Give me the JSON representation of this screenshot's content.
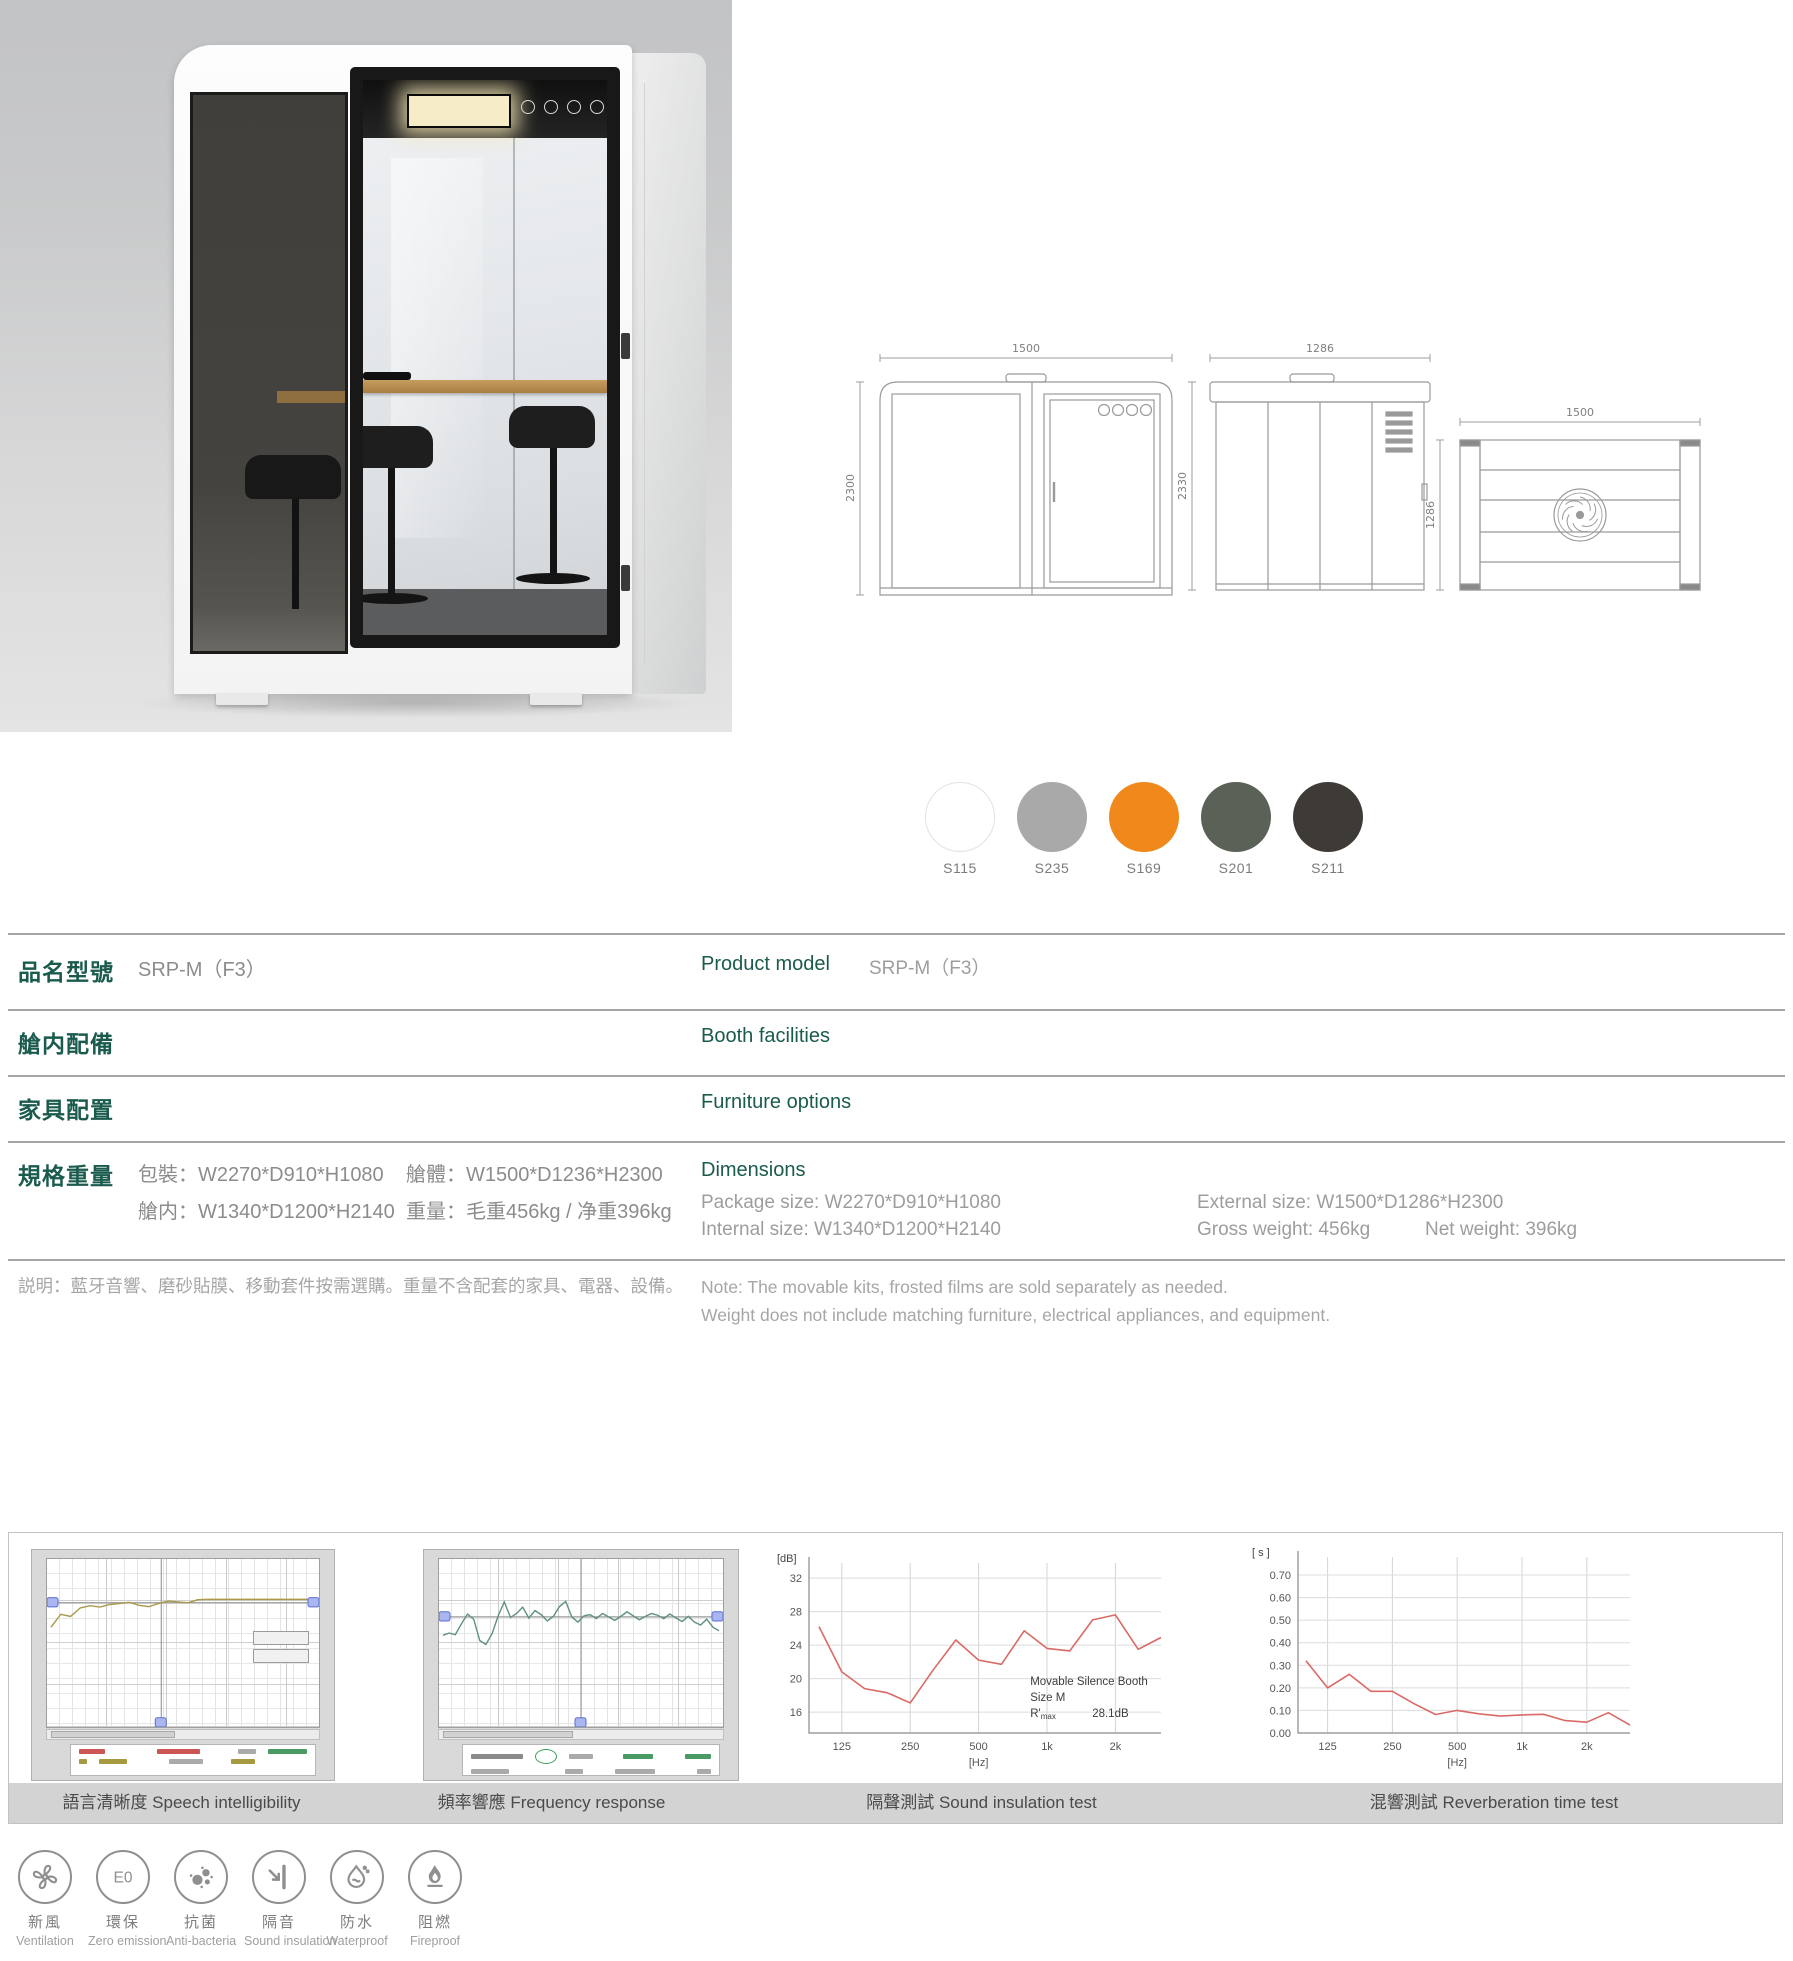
{
  "hero": {
    "drawings": {
      "front": {
        "width_mm": "1500",
        "height_mm": "2300"
      },
      "side": {
        "width_mm": "1286",
        "height_mm": "2330"
      },
      "top": {
        "width_mm": "1500",
        "depth_mm": "1286"
      }
    },
    "swatches": [
      {
        "code": "S115",
        "hex": "#ffffff"
      },
      {
        "code": "S235",
        "hex": "#a9a9a9"
      },
      {
        "code": "S169",
        "hex": "#f0881c"
      },
      {
        "code": "S201",
        "hex": "#5a6156"
      },
      {
        "code": "S211",
        "hex": "#3e3b37"
      }
    ]
  },
  "spec": {
    "accent_color": "#1a5b4d",
    "model": {
      "zh_label": "品名型號",
      "zh_value": "SRP-M（F3）",
      "en_label": "Product model",
      "en_value": "SRP-M（F3）"
    },
    "facilities": {
      "zh_label": "艙内配備",
      "zh_items": [
        "★適配100-240V/50-60Hz電源供應系統，符合不同電源使用需求",
        "★艙室4000K/750Lux自然光中央照明系統",
        "★渦輪正壓新風系統",
        "★紅外感應啓動裝置+手動開關",
        "★應急安全槌",
        "★雙層非等厚夾膠玻璃",
        "★加强框體液壓艙門"
      ],
      "en_label": "Booth facilities",
      "en_items": [
        "★ 100-240V/50-60Hz power supply.",
        "★ 4000K/750Lux natural lighting system.",
        "★ Turbo fresh air system.",
        "★ Motion sensor and switch control for light and fan.",
        "★ Emergency safety hammer.",
        "★ Double-layer non-equal thick laminated glass",
        "★ Advanced framed hydraulic door."
      ]
    },
    "furniture": {
      "zh_label": "家具配置",
      "zh_items": [
        "ST-03 吧臺桌 * 1",
        "SY-01 高脚椅 * 2"
      ],
      "en_label": "Furniture options",
      "en_items": [
        "ST-03 desk*1",
        "SY-01 chair*2"
      ]
    },
    "dimensions": {
      "zh_label": "規格重量",
      "zh_line1a": "包裝：W2270*D910*H1080",
      "zh_line1b": "艙體：W1500*D1236*H2300",
      "zh_line2a": "艙内：W1340*D1200*H2140",
      "zh_line2b": "重量：毛重456kg / 净重396kg",
      "en_label": "Dimensions",
      "en_line1a": "Package size: W2270*D910*H1080",
      "en_line1b": "External size: W1500*D1286*H2300",
      "en_line2a": "Internal size: W1340*D1200*H2140",
      "en_line2b": "Gross weight: 456kg",
      "en_line2c": "Net weight: 396kg"
    },
    "note": {
      "zh": "説明：藍牙音響、磨砂貼膜、移動套件按需選購。重量不含配套的家具、電器、設備。",
      "en_line1": "Note:  The movable kits, frosted films are sold separately as needed.",
      "en_line2": "Weight does not include matching furniture, electrical appliances, and equipment."
    }
  },
  "charts": {
    "captions": [
      "語言清晰度 Speech intelligibility",
      "頻率響應 Frequency response",
      "隔聲測試 Sound insulation test",
      "混響測試 Reverberation time test"
    ]
  },
  "chart_data": [
    {
      "type": "line",
      "id": "speech",
      "title": "語言清晰度 Speech intelligibility",
      "description": "Acoustic analyzer screenshot; scale text illegible in source",
      "values": [
        20.5,
        23.5,
        23,
        25,
        25.5,
        25.2,
        25.8,
        26,
        26.3,
        25.6,
        25.3,
        26,
        26.6,
        26.4,
        26.2,
        26.9,
        27,
        27,
        27,
        27,
        27,
        27,
        27,
        27,
        27,
        27,
        27,
        27
      ],
      "reference_value": 26.2,
      "cursor_x_fraction": 0.42,
      "ylim": [
        0,
        35
      ],
      "line_color": "#ab9a4b",
      "grid": true,
      "legend_position": "bottom"
    },
    {
      "type": "line",
      "id": "frequency-response",
      "title": "頻率響應 Frequency response",
      "description": "Acoustic analyzer screenshot; scale text illegible in source",
      "values": [
        13.8,
        14.2,
        13.9,
        15.8,
        17.5,
        16.6,
        12.9,
        12.2,
        14.1,
        17.2,
        19.6,
        16.9,
        17.6,
        18.7,
        16.8,
        18.1,
        17.4,
        16.3,
        17.1,
        18.8,
        19.7,
        17,
        16.1,
        17.2,
        17.4,
        16.7,
        17.6,
        17,
        16.4,
        17.1,
        17.9,
        17.2,
        16.5,
        17.1,
        17.6,
        17.3,
        16.7,
        17.5,
        16.8,
        16.2,
        17.1,
        16.1,
        15.6,
        16.6,
        15.2,
        14.6
      ],
      "reference_value": 17.0,
      "cursor_x_fraction": 0.5,
      "ylim": [
        0,
        26
      ],
      "line_color": "#5f9180",
      "grid": true,
      "legend_position": "bottom"
    },
    {
      "type": "line",
      "id": "sound-insulation",
      "title": "隔聲測試 Sound insulation test",
      "x": [
        "100",
        "125",
        "160",
        "200",
        "250",
        "315",
        "400",
        "500",
        "630",
        "800",
        "1k",
        "1.25k",
        "1.6k",
        "2k",
        "2.5k",
        "3.15k"
      ],
      "values": [
        26.2,
        20.8,
        18.8,
        18.3,
        17.1,
        21,
        24.6,
        22.2,
        21.7,
        25.7,
        23.6,
        23.3,
        27,
        27.6,
        23.5,
        24.9
      ],
      "xticks": {
        "labels": [
          "125",
          "250",
          "500",
          "1k",
          "2k"
        ],
        "indices": [
          1,
          4,
          7,
          10,
          13
        ]
      },
      "yticks": [
        16,
        20,
        24,
        28,
        32
      ],
      "ylim": [
        13.5,
        33.8
      ],
      "ylabel": "[dB]",
      "xlabel": "[Hz]",
      "line_color": "#d96a66",
      "annotation": {
        "line1": "Movable Silence Booth",
        "line2": "Size M",
        "r_label": "R'",
        "r_sub": "max",
        "r_value": "28.1dB"
      }
    },
    {
      "type": "line",
      "id": "reverberation-time",
      "title": "混響測試 Reverberation time test",
      "x": [
        "100",
        "125",
        "160",
        "200",
        "250",
        "315",
        "400",
        "500",
        "630",
        "800",
        "1k",
        "1.25k",
        "1.6k",
        "2k",
        "2.5k",
        "3.15k"
      ],
      "values": [
        0.32,
        0.2,
        0.26,
        0.185,
        0.185,
        0.13,
        0.082,
        0.1,
        0.085,
        0.075,
        0.08,
        0.083,
        0.055,
        0.048,
        0.09,
        0.035
      ],
      "xticks": {
        "labels": [
          "125",
          "250",
          "500",
          "1k",
          "2k"
        ],
        "indices": [
          1,
          4,
          7,
          10,
          13
        ]
      },
      "yticks": [
        0,
        0.1,
        0.2,
        0.3,
        0.4,
        0.5,
        0.6,
        0.7
      ],
      "ytick_labels": [
        "0.00",
        "0.10",
        "0.20",
        "0.30",
        "0.40",
        "0.50",
        "0.60",
        "0.70"
      ],
      "ylim": [
        0,
        0.78
      ],
      "ylabel": "[ s ]",
      "xlabel": "[Hz]",
      "line_color": "#d96a66",
      "corner_text": [
        "Size M RT",
        "Cursor values",
        "X: 1KHz",
        "T20: 0.10s"
      ]
    }
  ],
  "badges": [
    {
      "icon": "fan",
      "zh": "新風",
      "en": "Ventilation"
    },
    {
      "icon": "e0",
      "zh": "環保",
      "en": "Zero emission"
    },
    {
      "icon": "bacteria",
      "zh": "抗菌",
      "en": "Anti-bacteria"
    },
    {
      "icon": "insulation",
      "zh": "隔音",
      "en": "Sound insulation"
    },
    {
      "icon": "waterproof",
      "zh": "防水",
      "en": "Waterproof"
    },
    {
      "icon": "fireproof",
      "zh": "阻燃",
      "en": "Fireproof"
    }
  ]
}
